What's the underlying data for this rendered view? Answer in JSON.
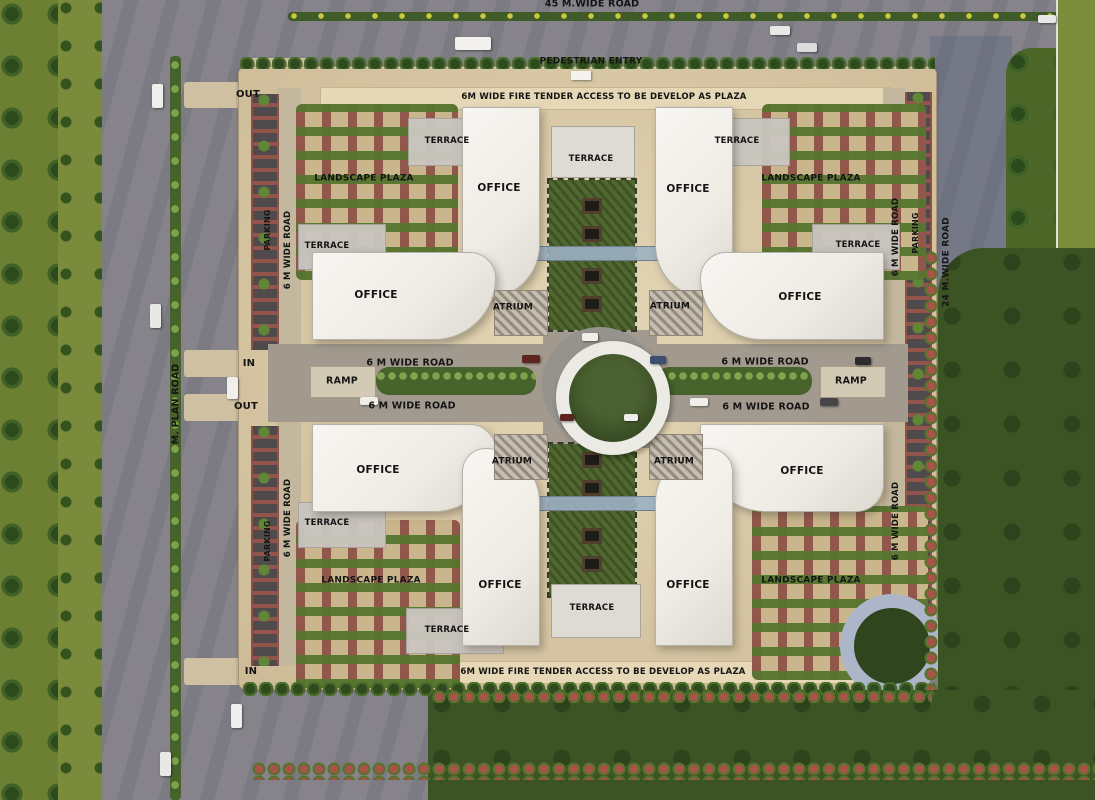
{
  "colors": {
    "road": "#86848a",
    "grass": "#6d7f33",
    "verge": "#7a8c3c",
    "lawn": "#3c5323",
    "lawn_strip": "#4c6628",
    "grass_far": "#7b8d3d",
    "site": "#d6c5a2",
    "banner": "#e6d8b7",
    "building": "#eeebe4",
    "plaza_base": "#c9b68c",
    "plaza_green": "#5a7630",
    "plaza_maroon": "#8a4a42",
    "parking_red": "#93554b",
    "parking_slot": "#4f4b4c",
    "median_green": "#5b7a34",
    "courtyard": "#50682f",
    "gray_paving": "#a29a8e",
    "ring_white": "#eceae4",
    "circle_green": "#374b24",
    "label": "#141414"
  },
  "labels": [
    {
      "name": "label-45m-wide-road",
      "text": "45 M.WIDE ROAD",
      "x": 592,
      "y": 4,
      "size": 9.5
    },
    {
      "name": "label-pedestrian-entry",
      "text": "PEDESTRIAN ENTRY",
      "x": 591,
      "y": 62,
      "size": 9
    },
    {
      "name": "label-out-top",
      "text": "OUT",
      "x": 248,
      "y": 95,
      "size": 10
    },
    {
      "name": "label-fire-access-top",
      "text": "6M WIDE FIRE TENDER ACCESS TO BE DEVELOP AS PLAZA",
      "x": 604,
      "y": 97,
      "size": 8.5
    },
    {
      "name": "label-terrace-tl-upper",
      "text": "TERRACE",
      "x": 447,
      "y": 141,
      "size": 8.5
    },
    {
      "name": "label-terrace-center-top",
      "text": "TERRACE",
      "x": 591,
      "y": 159,
      "size": 8.5
    },
    {
      "name": "label-terrace-tr-upper",
      "text": "TERRACE",
      "x": 737,
      "y": 141,
      "size": 8.5
    },
    {
      "name": "label-landscape-plaza-tl",
      "text": "LANDSCAPE PLAZA",
      "x": 364,
      "y": 179,
      "size": 9
    },
    {
      "name": "label-landscape-plaza-tr",
      "text": "LANDSCAPE PLAZA",
      "x": 811,
      "y": 179,
      "size": 9
    },
    {
      "name": "label-office-tl-vertical",
      "text": "OFFICE",
      "x": 499,
      "y": 188,
      "size": 10.5
    },
    {
      "name": "label-office-tr-vertical",
      "text": "OFFICE",
      "x": 688,
      "y": 189,
      "size": 10.5
    },
    {
      "name": "label-parking-left-top",
      "text": "PARKING",
      "x": 268,
      "y": 230,
      "rot": -90,
      "size": 8
    },
    {
      "name": "label-6m-road-left-top",
      "text": "6 M WIDE ROAD",
      "x": 288,
      "y": 250,
      "rot": -90,
      "size": 8.5
    },
    {
      "name": "label-terrace-tl-left",
      "text": "TERRACE",
      "x": 327,
      "y": 246,
      "size": 8.5
    },
    {
      "name": "label-terrace-tr-right",
      "text": "TERRACE",
      "x": 858,
      "y": 245,
      "size": 8.5
    },
    {
      "name": "label-6m-road-right-top",
      "text": "6 M WIDE ROAD",
      "x": 896,
      "y": 237,
      "rot": -90,
      "size": 8.5
    },
    {
      "name": "label-parking-right",
      "text": "PARKING",
      "x": 916,
      "y": 233,
      "rot": -90,
      "size": 8
    },
    {
      "name": "label-24m-wide-road",
      "text": "24 M.WIDE ROAD",
      "x": 947,
      "y": 262,
      "rot": -90,
      "size": 9
    },
    {
      "name": "label-office-tl-horizontal",
      "text": "OFFICE",
      "x": 376,
      "y": 295,
      "size": 10.5
    },
    {
      "name": "label-office-tr-horizontal",
      "text": "OFFICE",
      "x": 800,
      "y": 297,
      "size": 10.5
    },
    {
      "name": "label-atrium-tl",
      "text": "ATRIUM",
      "x": 513,
      "y": 308,
      "size": 9
    },
    {
      "name": "label-atrium-tr",
      "text": "ATRIUM",
      "x": 670,
      "y": 307,
      "size": 9
    },
    {
      "name": "label-m-plan-road",
      "text": "M. PLAN ROAD",
      "x": 176,
      "y": 404,
      "rot": -90,
      "size": 9.5
    },
    {
      "name": "label-in-mid",
      "text": "IN",
      "x": 249,
      "y": 364,
      "size": 10
    },
    {
      "name": "label-out-mid",
      "text": "OUT",
      "x": 246,
      "y": 407,
      "size": 10
    },
    {
      "name": "label-6m-road-center-left-upper",
      "text": "6 M WIDE ROAD",
      "x": 410,
      "y": 363,
      "size": 9.5
    },
    {
      "name": "label-ramp-left",
      "text": "RAMP",
      "x": 342,
      "y": 381,
      "size": 9.5
    },
    {
      "name": "label-6m-road-center-left-lower",
      "text": "6 M WIDE ROAD",
      "x": 412,
      "y": 406,
      "size": 9.5
    },
    {
      "name": "label-6m-road-center-right-upper",
      "text": "6 M WIDE ROAD",
      "x": 765,
      "y": 362,
      "size": 9.5
    },
    {
      "name": "label-ramp-right",
      "text": "RAMP",
      "x": 851,
      "y": 381,
      "size": 9.5
    },
    {
      "name": "label-6m-road-center-right-lower",
      "text": "6 M WIDE ROAD",
      "x": 766,
      "y": 407,
      "size": 9.5
    },
    {
      "name": "label-office-bl-horizontal",
      "text": "OFFICE",
      "x": 378,
      "y": 470,
      "size": 10.5
    },
    {
      "name": "label-atrium-bl",
      "text": "ATRIUM",
      "x": 512,
      "y": 462,
      "size": 9
    },
    {
      "name": "label-atrium-br",
      "text": "ATRIUM",
      "x": 674,
      "y": 462,
      "size": 9
    },
    {
      "name": "label-office-br-horizontal",
      "text": "OFFICE",
      "x": 802,
      "y": 471,
      "size": 10.5
    },
    {
      "name": "label-terrace-bl-left",
      "text": "TERRACE",
      "x": 327,
      "y": 523,
      "size": 8.5
    },
    {
      "name": "label-6m-road-left-bottom",
      "text": "6 M WIDE ROAD",
      "x": 288,
      "y": 518,
      "rot": -90,
      "size": 8.5
    },
    {
      "name": "label-parking-left-bottom",
      "text": "PARKING",
      "x": 268,
      "y": 541,
      "rot": -90,
      "size": 8
    },
    {
      "name": "label-6m-road-right-bottom",
      "text": "6 M WIDE ROAD",
      "x": 896,
      "y": 521,
      "rot": -90,
      "size": 8.5
    },
    {
      "name": "label-landscape-plaza-bl",
      "text": "LANDSCAPE PLAZA",
      "x": 371,
      "y": 581,
      "size": 9
    },
    {
      "name": "label-landscape-plaza-br",
      "text": "LANDSCAPE PLAZA",
      "x": 811,
      "y": 581,
      "size": 9
    },
    {
      "name": "label-office-bl-vertical",
      "text": "OFFICE",
      "x": 500,
      "y": 585,
      "size": 10.5
    },
    {
      "name": "label-office-br-vertical",
      "text": "OFFICE",
      "x": 688,
      "y": 585,
      "size": 10.5
    },
    {
      "name": "label-terrace-center-bottom",
      "text": "TERRACE",
      "x": 592,
      "y": 608,
      "size": 8.5
    },
    {
      "name": "label-terrace-bl-lower",
      "text": "TERRACE",
      "x": 447,
      "y": 630,
      "size": 8.5
    },
    {
      "name": "label-in-bottom",
      "text": "IN",
      "x": 251,
      "y": 672,
      "size": 10
    },
    {
      "name": "label-fire-access-bottom",
      "text": "6M WIDE FIRE TENDER ACCESS TO BE DEVELOP AS PLAZA",
      "x": 603,
      "y": 672,
      "size": 8.5
    }
  ]
}
